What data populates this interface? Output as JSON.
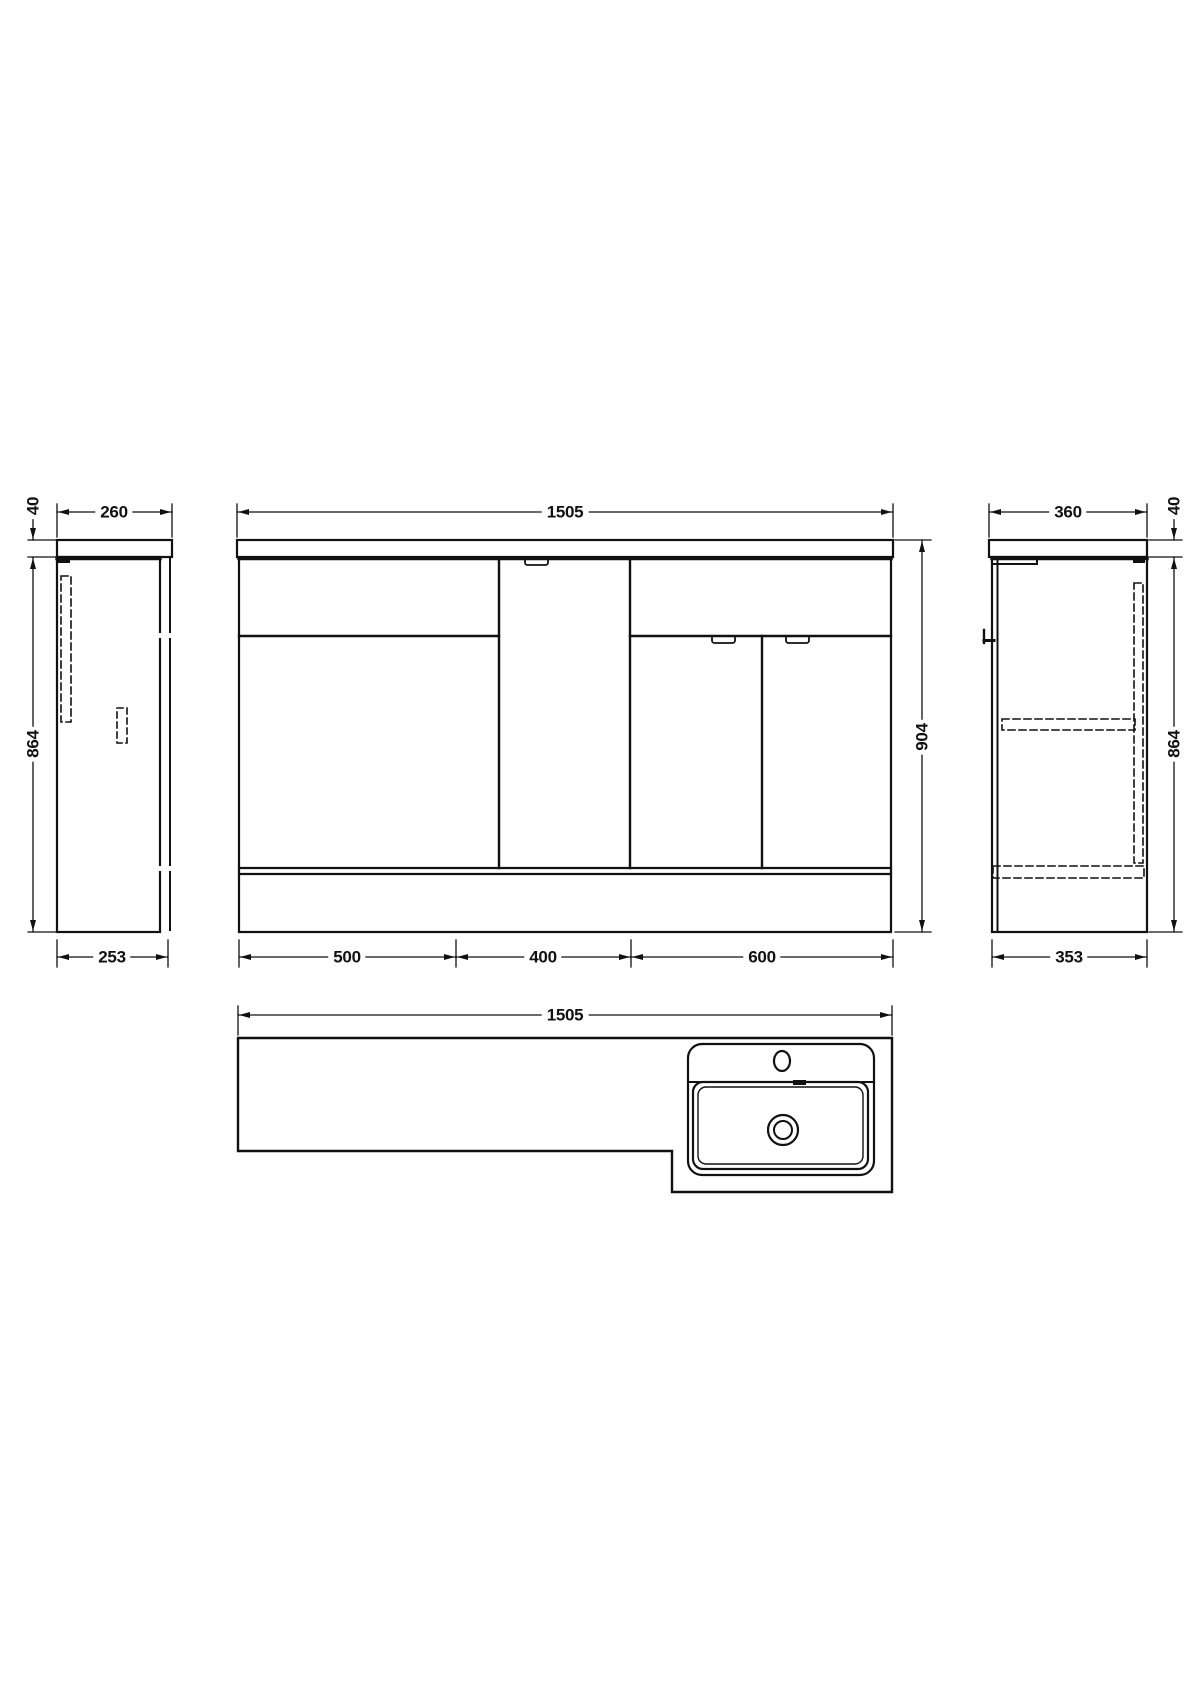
{
  "drawing": {
    "type": "technical-dimension-drawing",
    "line_color": "#111111",
    "background": "#ffffff",
    "views": {
      "left_side": {
        "top_width": "260",
        "countertop_thickness": "40",
        "height": "864",
        "bottom_depth": "253"
      },
      "front": {
        "top_width": "1505",
        "height": "904",
        "sections": [
          "500",
          "400",
          "600"
        ]
      },
      "right_side": {
        "top_width": "360",
        "countertop_thickness": "40",
        "height": "864",
        "bottom_depth": "353"
      },
      "plan": {
        "width": "1505"
      }
    }
  }
}
